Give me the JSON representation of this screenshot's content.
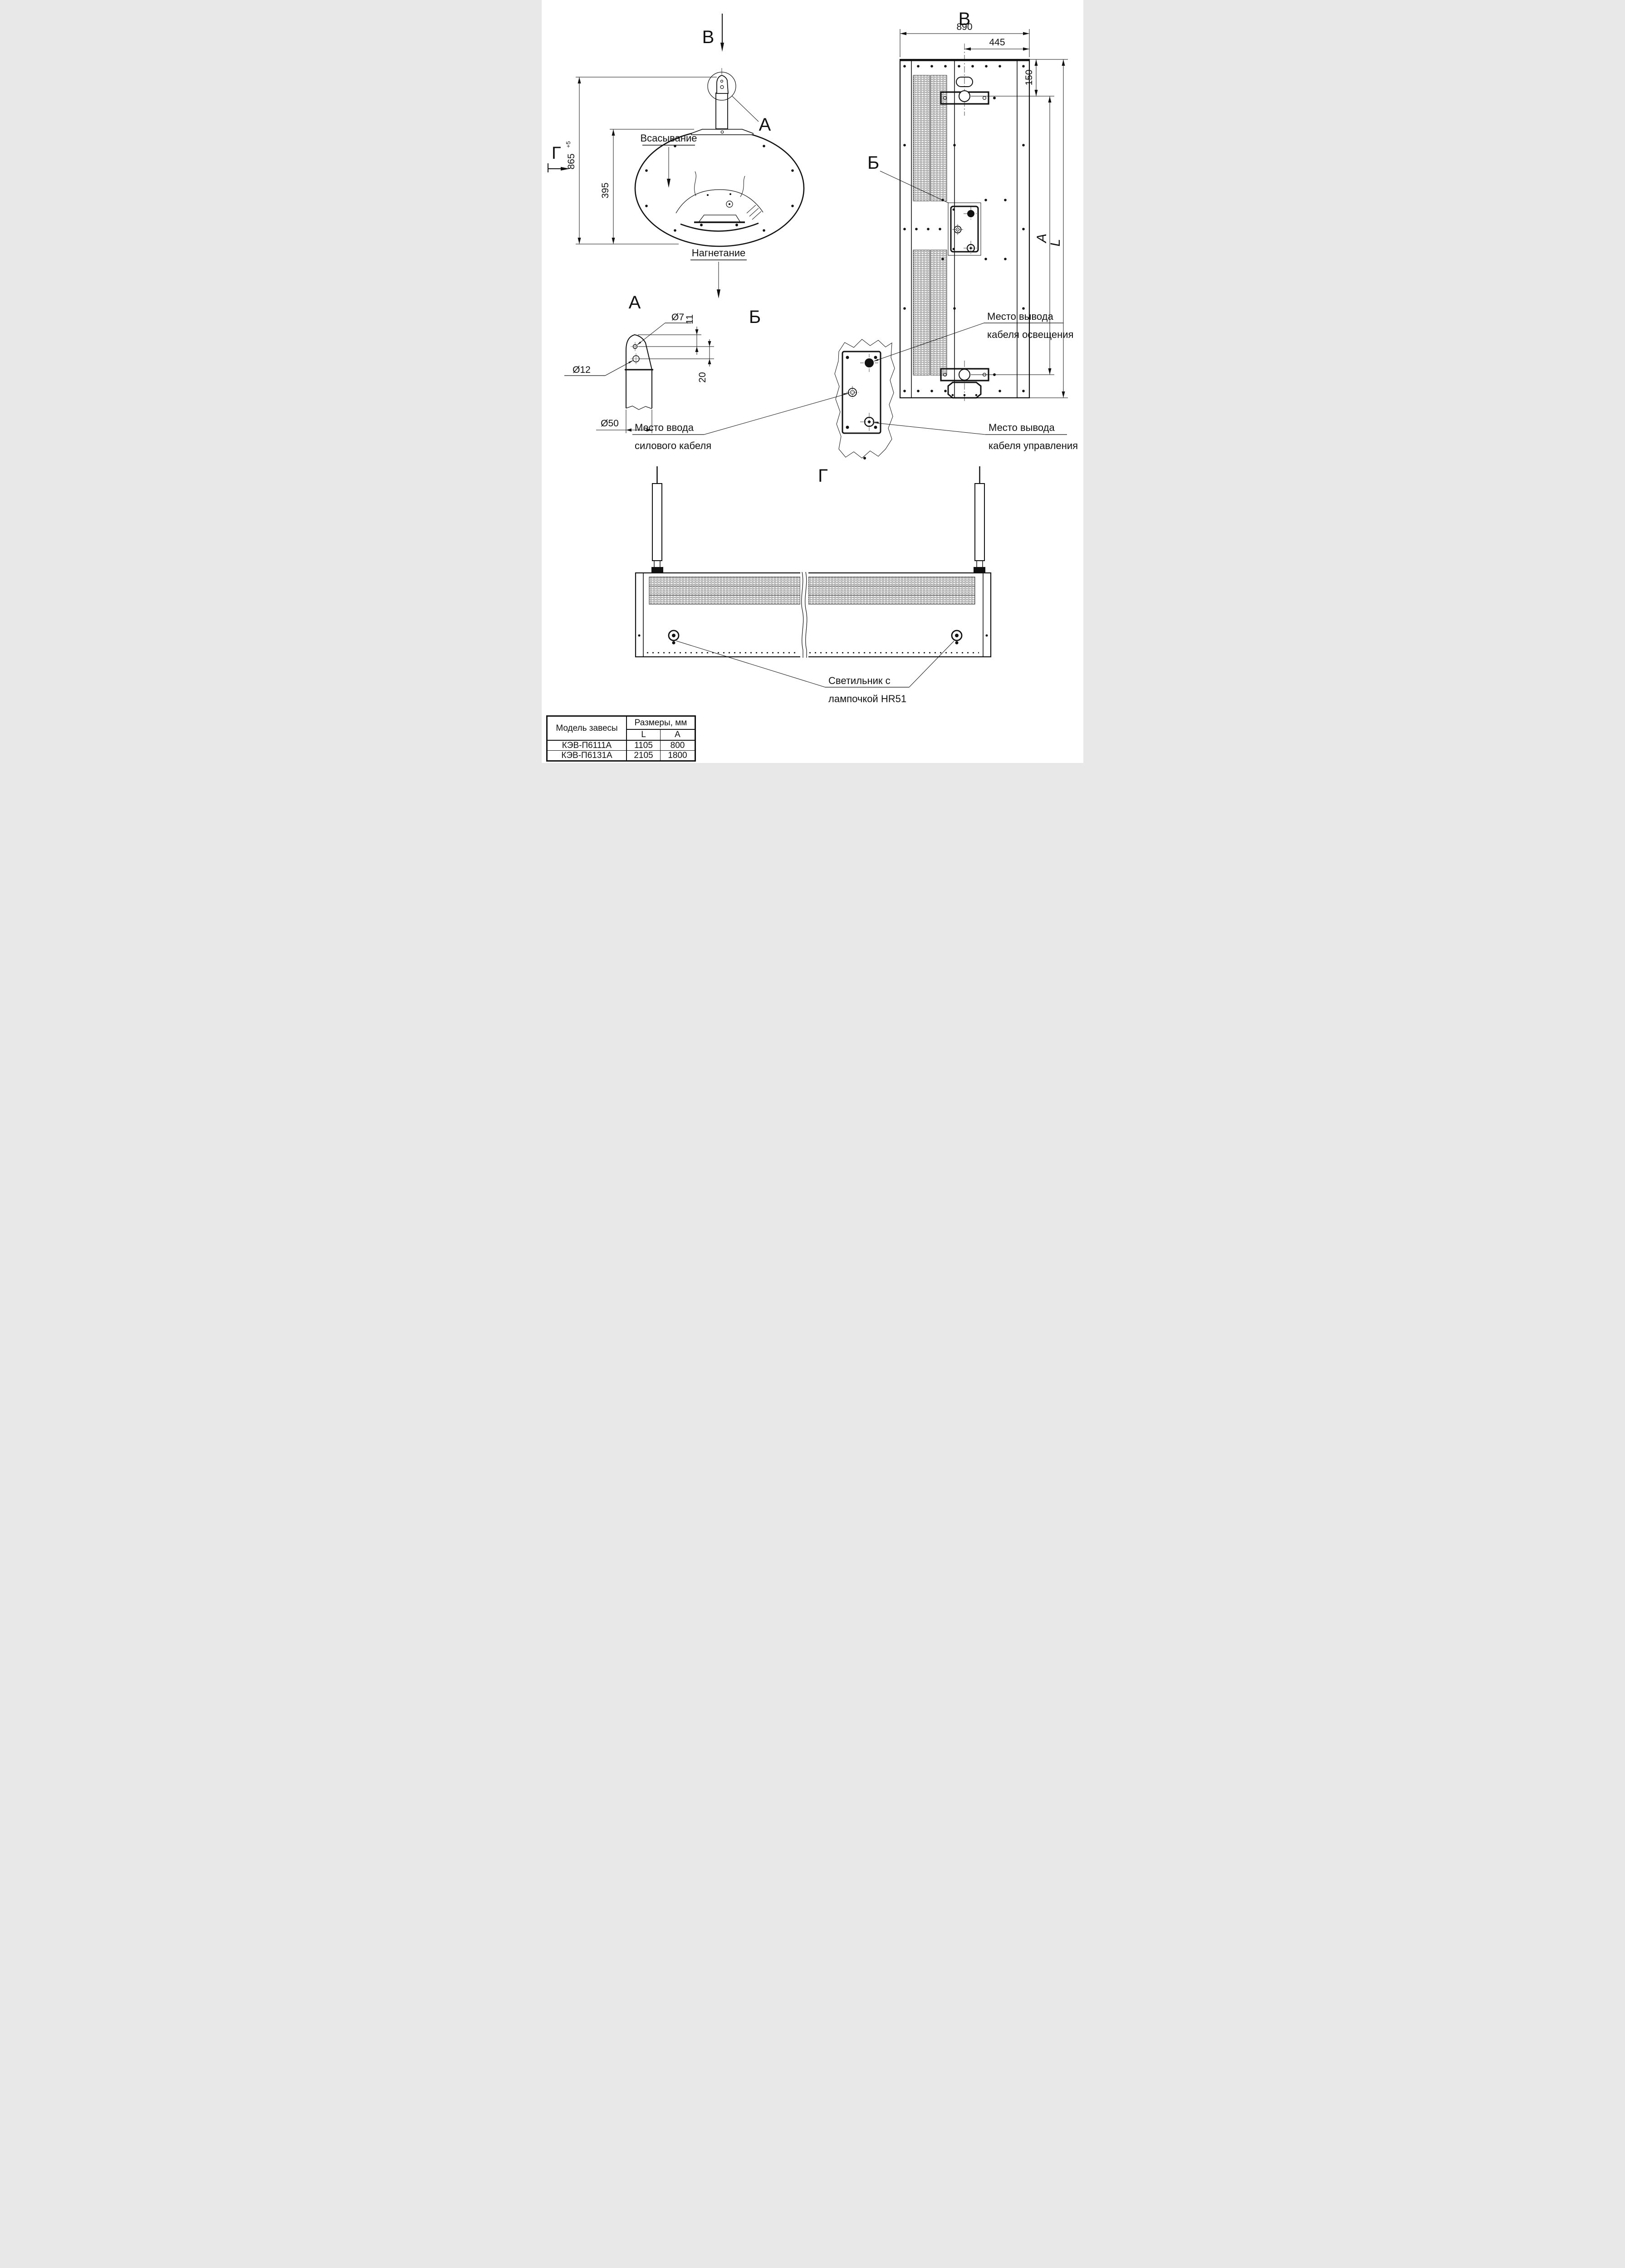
{
  "side_view": {
    "marker_b": "В",
    "marker_g": "Г",
    "detail_ref_a": "А",
    "suction": "Всасывание",
    "discharge": "Нагнетание",
    "dim_height": "865",
    "dim_height_tol": "+5",
    "dim_inner": "395"
  },
  "rear_view": {
    "title": "В",
    "detail_ref_b": "Б",
    "dim_width": "890",
    "dim_center": "445",
    "dim_top": "150",
    "dim_mount_span": "А",
    "dim_total": "L"
  },
  "detail_a": {
    "title": "А",
    "dia_hole_small": "Ø7",
    "dia_hole_big": "Ø12",
    "dia_tube": "Ø50",
    "dim_top_offset": "11",
    "dim_hole_spacing": "20"
  },
  "detail_b": {
    "title": "Б",
    "lighting": [
      "Место вывода",
      "кабеля освещения"
    ],
    "power": [
      "Место ввода",
      "силового кабеля"
    ],
    "control": [
      "Место вывода",
      "кабеля управления"
    ]
  },
  "bottom_view": {
    "title": "Г",
    "lamp": [
      "Светильник с",
      "лампочкой HR51"
    ]
  },
  "table": {
    "model_header": "Модель завесы",
    "dims_header": "Размеры, мм",
    "col_l": "L",
    "col_a": "А",
    "rows": [
      {
        "model": "КЭВ-П6111А",
        "l": "1105",
        "a": "800"
      },
      {
        "model": "КЭВ-П6131А",
        "l": "2105",
        "a": "1800"
      }
    ]
  }
}
